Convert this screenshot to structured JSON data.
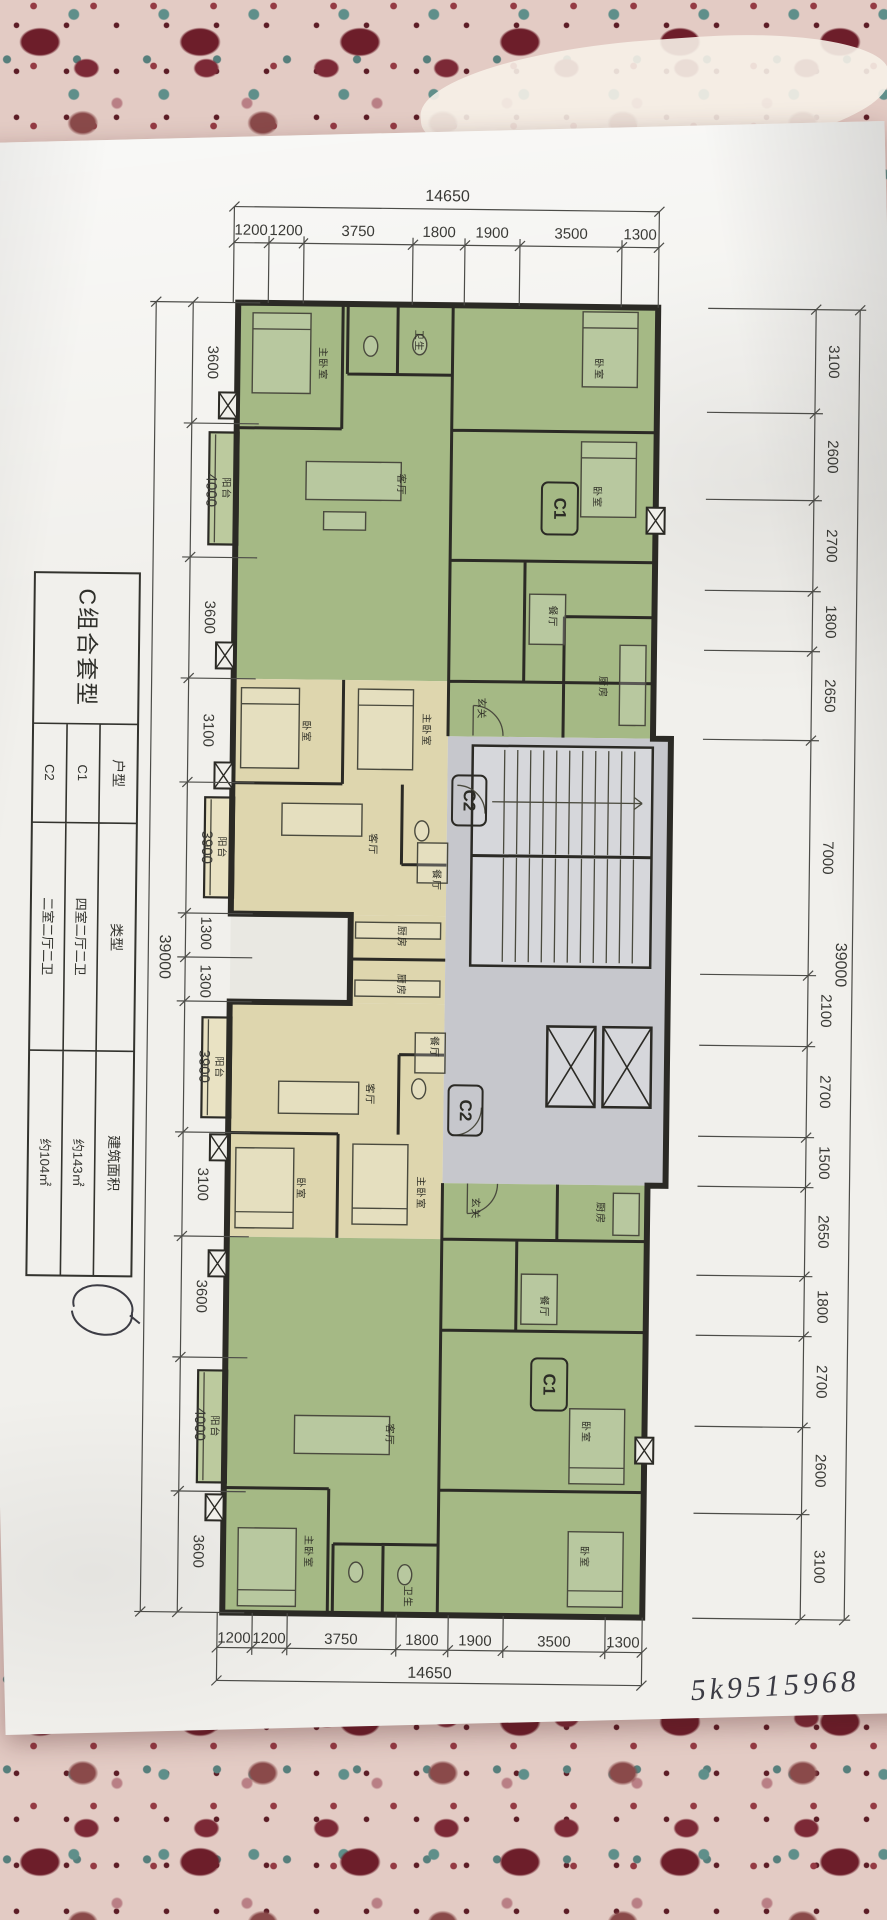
{
  "dims": {
    "top": {
      "total": "14650",
      "segments": [
        "1200",
        "1200",
        "3750",
        "1800",
        "1900",
        "3500",
        "1300"
      ]
    },
    "bottom": {
      "total": "14650",
      "segments": [
        "1200",
        "1200",
        "3750",
        "1800",
        "1900",
        "3500",
        "1300"
      ]
    },
    "left": {
      "total": "39000",
      "segments": [
        "3600",
        "4000",
        "3600",
        "3100",
        "3900",
        "1300",
        "1300",
        "3900",
        "3100",
        "3600",
        "4000",
        "3600"
      ]
    },
    "right": {
      "total": "39000",
      "segments": [
        "3100",
        "2600",
        "2700",
        "1800",
        "2650",
        "7000",
        "2100",
        "2700",
        "1500",
        "2650",
        "1800",
        "2700",
        "2600",
        "3100"
      ]
    }
  },
  "table": {
    "title": "C组合套型",
    "headers": [
      "户型",
      "类型",
      "建筑面积"
    ],
    "rows": [
      [
        "C1",
        "四室二厅二卫",
        "约143㎡"
      ],
      [
        "C2",
        "二室二厅二卫",
        "约104㎡"
      ]
    ]
  },
  "units": {
    "c1": "C1",
    "c2": "C2"
  },
  "rooms": {
    "master_bedroom": "主卧室",
    "bedroom": "卧室",
    "living_room": "客厅",
    "dining_room": "餐厅",
    "kitchen": "厨房",
    "balcony": "阳台",
    "entry": "玄关",
    "bath": "卫生"
  },
  "annotations": {
    "handwritten_number": "5k9515968"
  },
  "colors": {
    "unit_c1_green": "#a5b985",
    "unit_c1_green_light": "#bcca9e",
    "unit_c2_cream": "#ded6ae",
    "unit_c2_cream_light": "#e9e2c3",
    "core_gray": "#c6c7cc",
    "core_gray_light": "#d6d7db",
    "wall": "#2b2a25",
    "paper": "#f1f0ec"
  }
}
